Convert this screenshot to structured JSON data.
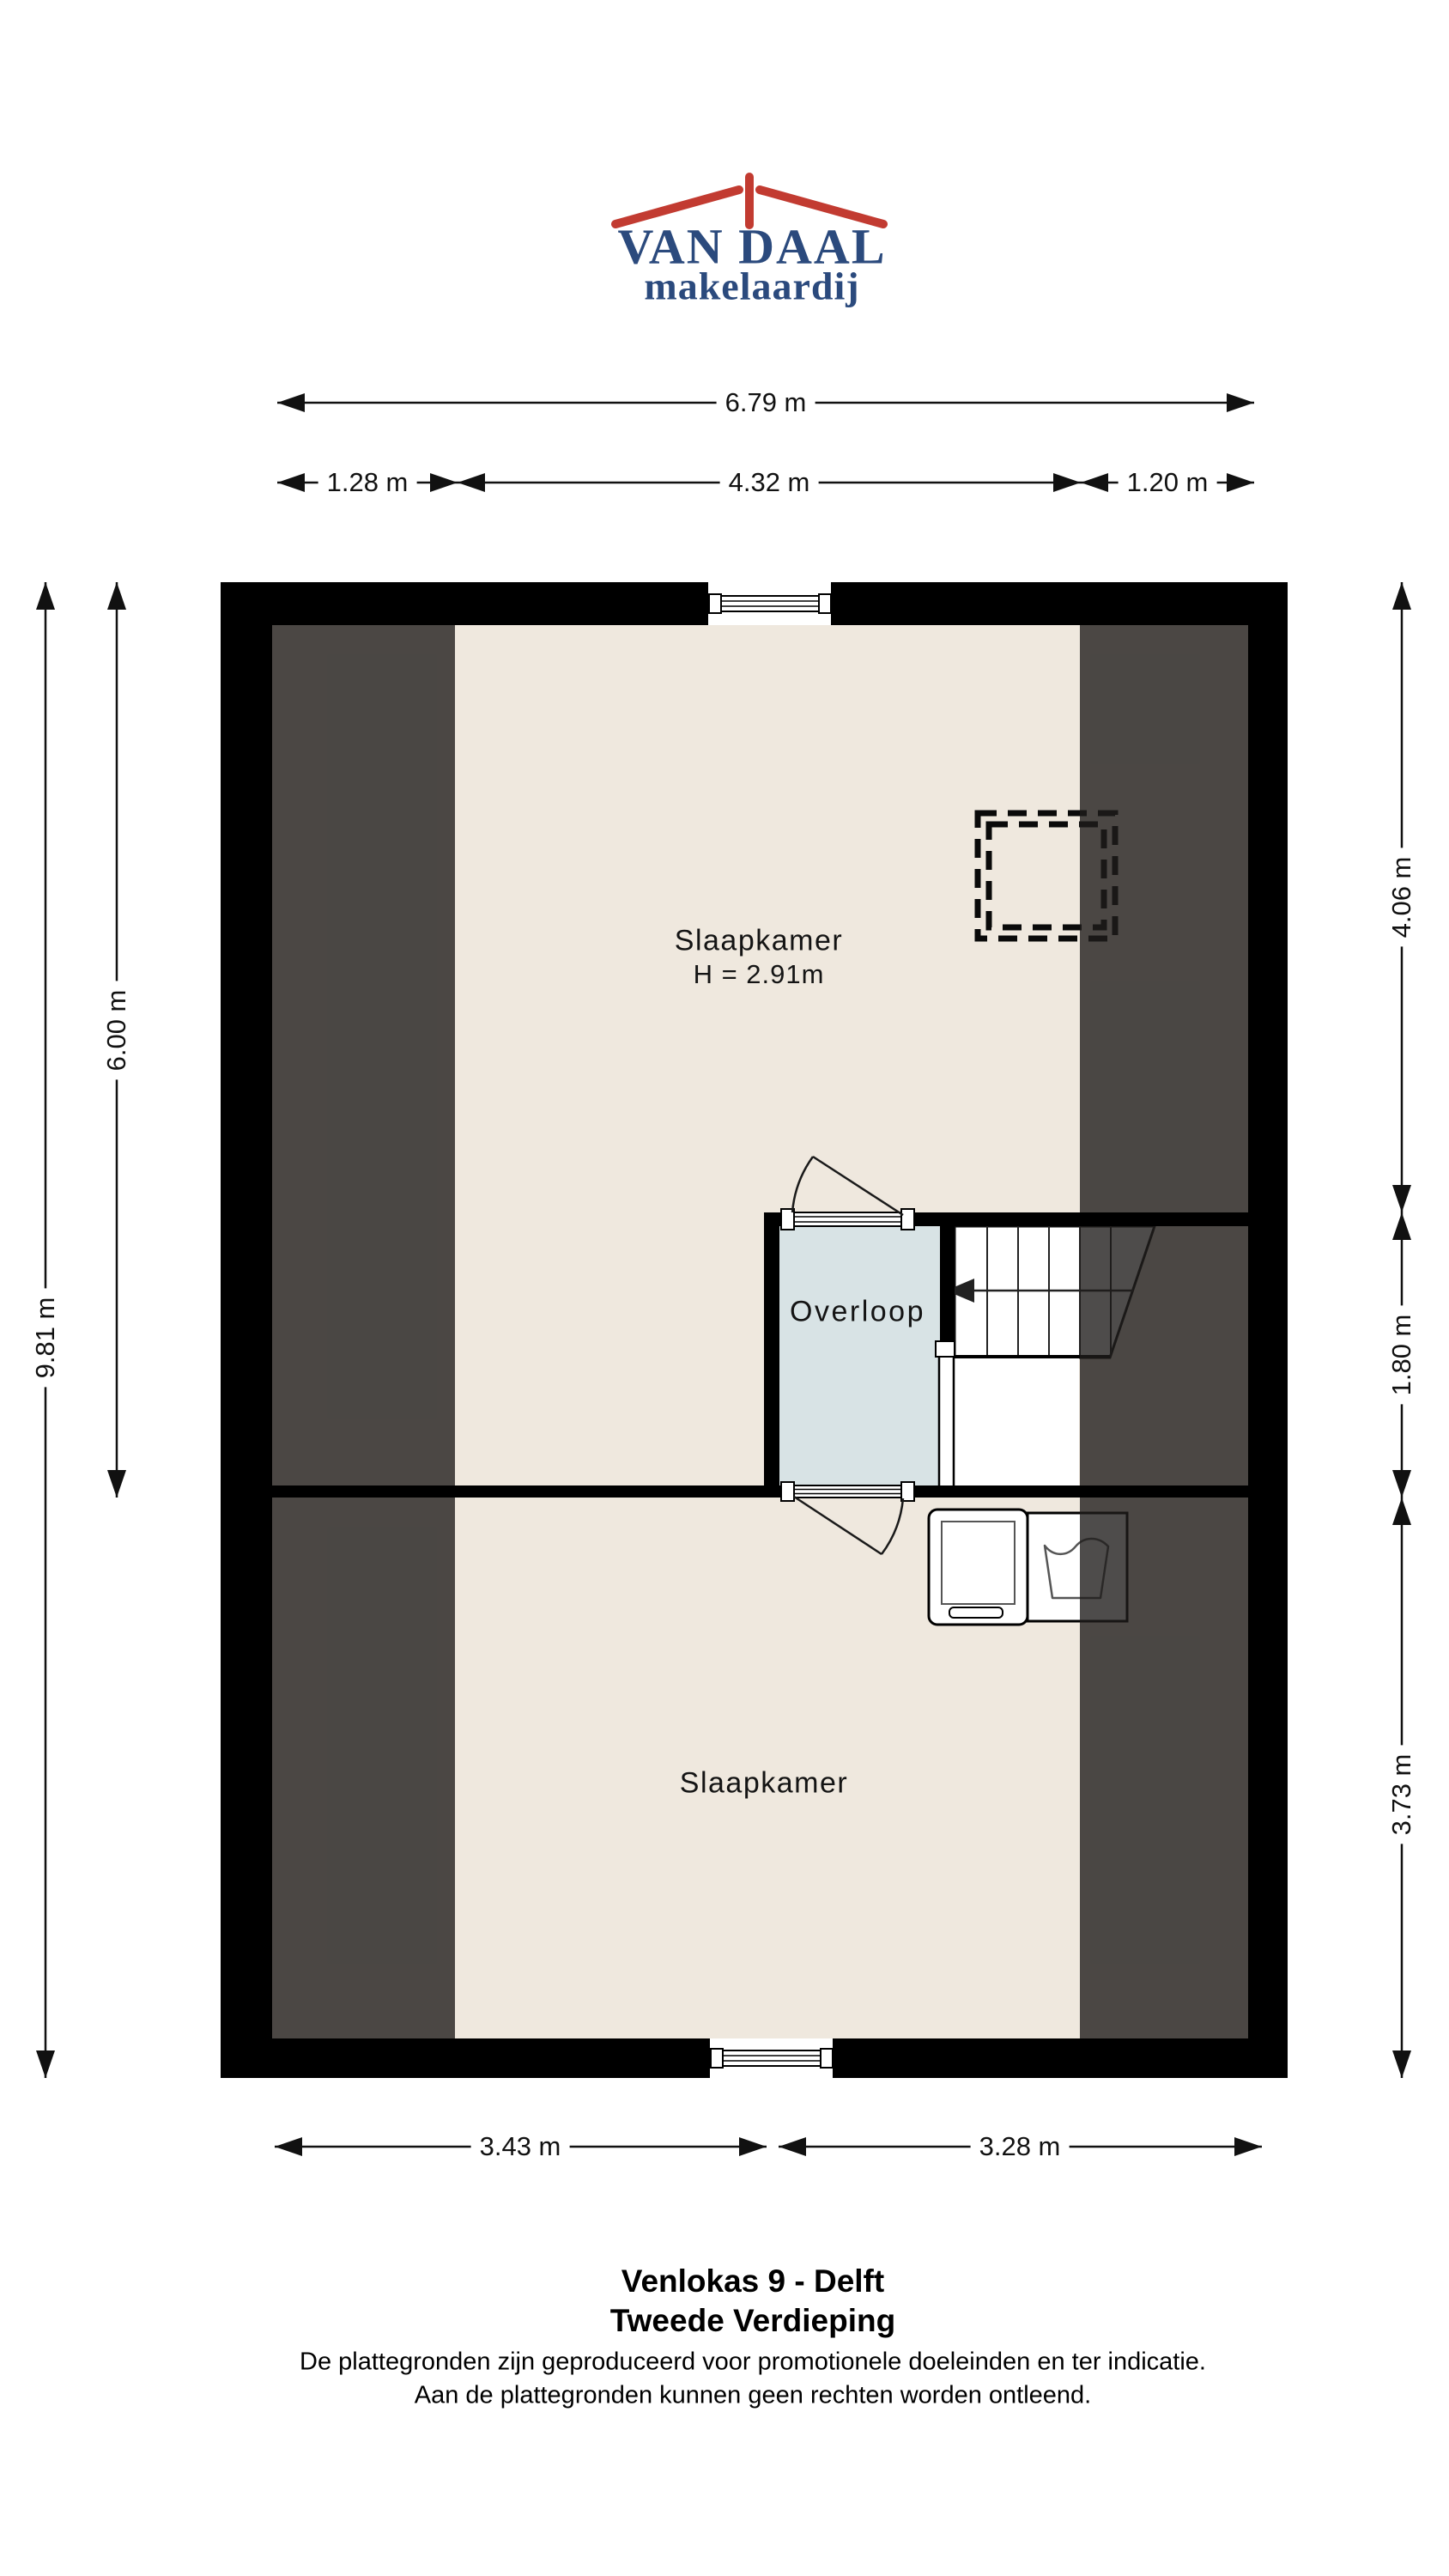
{
  "logo": {
    "brand": "VAN DAAL",
    "tagline": "makelaardij"
  },
  "dimensions": {
    "top_total": "6.79 m",
    "top_left": "1.28 m",
    "top_center": "4.32 m",
    "top_right": "1.20 m",
    "side_left_total": "9.81 m",
    "side_left_upper": "6.00 m",
    "side_right_top": "4.06 m",
    "side_right_middle": "1.80 m",
    "side_right_bottom": "3.73 m",
    "bottom_left": "3.43 m",
    "bottom_right": "3.28 m"
  },
  "rooms": {
    "bedroom_top": {
      "label": "Slaapkamer",
      "ceiling_height": "H = 2.91m"
    },
    "hallway": {
      "label": "Overloop"
    },
    "bedroom_bottom": {
      "label": "Slaapkamer"
    }
  },
  "footer": {
    "title": "Venlokas 9 - Delft",
    "subtitle": "Tweede Verdieping",
    "disclaimer_line1": "De plattegronden zijn geproduceerd voor promotionele doeleinden en ter indicatie.",
    "disclaimer_line2": "Aan de plattegronden kunnen geen rechten worden ontleend."
  },
  "colors": {
    "wall": "#000000",
    "floor": "#efe8de",
    "hallway_floor": "#d8e3e5",
    "sloped_ceiling_zone": "#4a4745",
    "logo_red": "#c23b31",
    "logo_blue": "#2b4a7d"
  }
}
